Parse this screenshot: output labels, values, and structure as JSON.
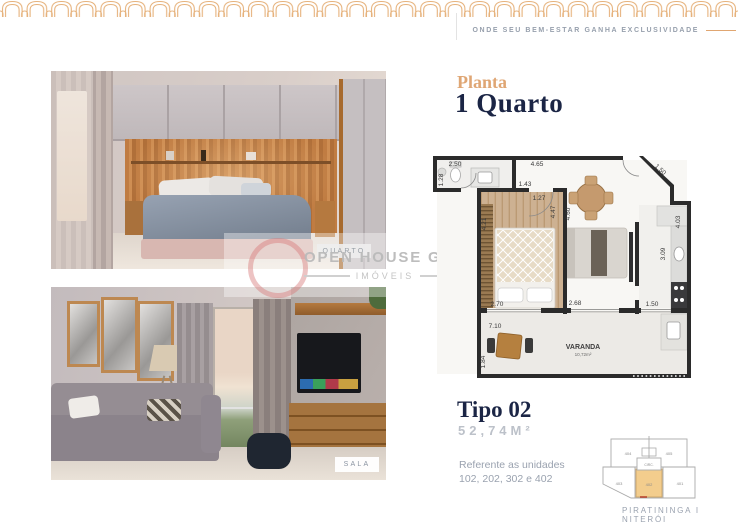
{
  "header": {
    "tagline": "ONDE SEU BEM-ESTAR GANHA EXCLUSIVIDADE",
    "pattern_color": "#e6b27c",
    "accent_color": "#dfa674",
    "navy_color": "#1b2545"
  },
  "photos": {
    "bedroom_label": "QUARTO",
    "living_label": "SALA"
  },
  "watermark": {
    "line1": "OPEN HOUSE GROUP",
    "line2": "IMÓVEIS"
  },
  "plan": {
    "eyebrow": "Planta",
    "title": "1 Quarto",
    "varanda_label": "VARANDA",
    "varanda_area": "10,72m²",
    "measurements": {
      "bath_w": "2.50",
      "bath_h": "1.28",
      "top_w": "4.65",
      "diag": "1.50",
      "bed_w1": "1.43",
      "bed_w2": "1.27",
      "bed_h": "4.21",
      "bed_side": "4.47",
      "living_side": "4.60",
      "kitchen_side": "4.03",
      "kitchen_inner": "3.09",
      "open_bed": "2.70",
      "open_living": "2.68",
      "open_kitchen": "1.50",
      "varanda_w": "7.10",
      "varanda_h": "1.84"
    }
  },
  "info": {
    "type_label": "Tipo 02",
    "area": "52,74M²",
    "ref1": "Referente as unidades",
    "ref2": "102, 202, 302 e 402"
  },
  "keyplan": {
    "u404": "404",
    "u405": "405",
    "u403": "403",
    "u402": "402",
    "u401": "401",
    "circ": "CIRC.",
    "highlight_color": "#f3cd8d",
    "location": "PIRATININGA I NITERÓI"
  }
}
